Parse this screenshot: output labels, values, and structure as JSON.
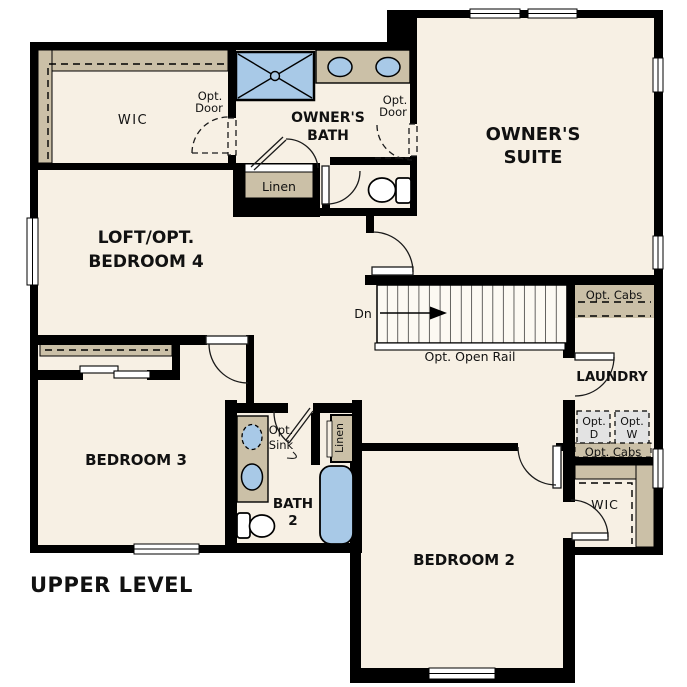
{
  "title": {
    "upper_level": "UPPER LEVEL"
  },
  "rooms": {
    "wic_owner": "WIC",
    "owners_bath": [
      "OWNER'S",
      "BATH"
    ],
    "owners_suite": [
      "OWNER'S",
      "SUITE"
    ],
    "loft": [
      "LOFT/OPT.",
      "BEDROOM 4"
    ],
    "bedroom3": "BEDROOM 3",
    "bath2": [
      "BATH",
      "2"
    ],
    "bedroom2": "BEDROOM 2",
    "laundry": "LAUNDRY",
    "wic_bedroom2": "WIC"
  },
  "annotations": {
    "opt_door_wic": [
      "Opt.",
      "Door"
    ],
    "opt_door_suite": [
      "Opt.",
      "Door"
    ],
    "linen_owner": "Linen",
    "linen_bath2": "Linen",
    "stairs_dn": "Dn",
    "opt_open_rail": "Opt. Open Rail",
    "opt_cabs_upper": "Opt. Cabs",
    "opt_cabs_lower": "Opt. Cabs",
    "opt_dryer": [
      "Opt.",
      "D"
    ],
    "opt_washer": [
      "Opt.",
      "W"
    ],
    "opt_sink": [
      "Opt.",
      "Sink"
    ]
  },
  "colors": {
    "wall": "#000000",
    "floor": "#f7f0e4",
    "cabinetry_tan": "#cbc0a7",
    "fixture_blue": "#a8c9e7",
    "optional_appliance_gray": "#e3e3e3",
    "outside": "#ffffff",
    "text": "#111111"
  }
}
